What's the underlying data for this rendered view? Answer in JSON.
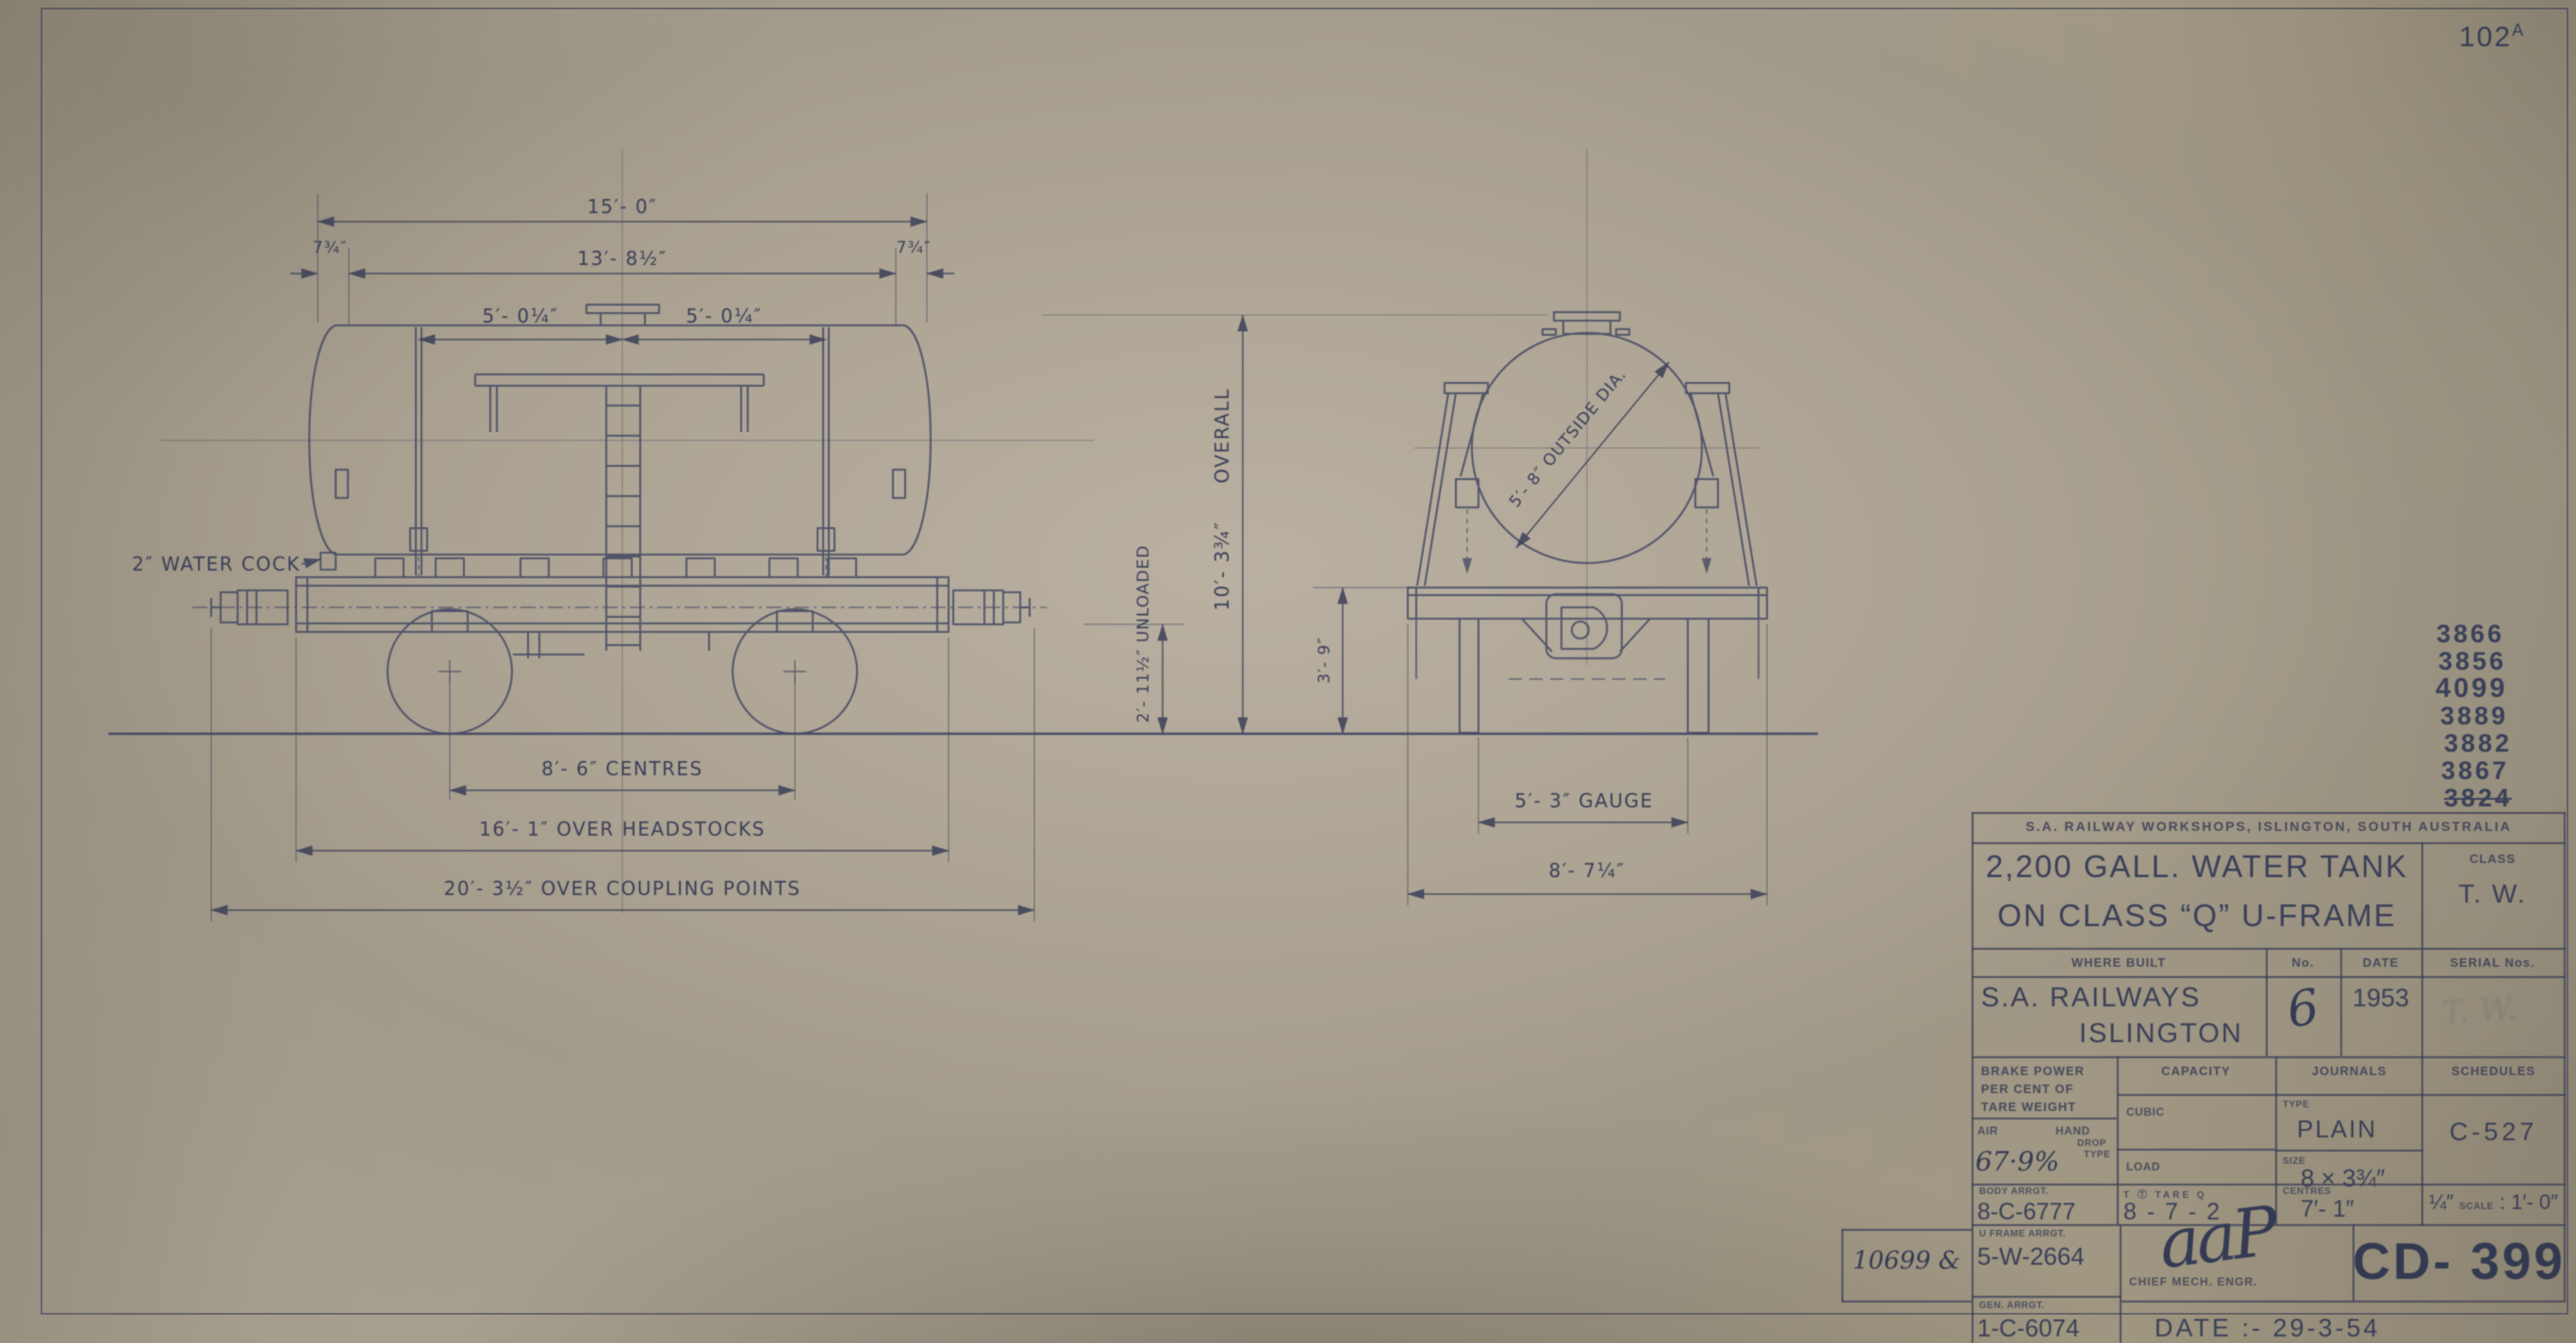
{
  "colors": {
    "paper": "#aaa292",
    "ink": "#3a3f58"
  },
  "sheet": {
    "number": "102",
    "number_suffix": "A",
    "date_note": "DATE :- 29-3-54"
  },
  "serials": {
    "list": [
      "3866",
      "3856",
      "4099",
      "3889",
      "3882",
      "3867"
    ],
    "struck": "3824"
  },
  "side_view": {
    "len_overall": "15′- 0″",
    "len_tank": "13′- 8½″",
    "end_offset": "7¾″",
    "half_left": "5′- 0¼″",
    "half_right": "5′- 0¼″",
    "water_cock": "2″ WATER COCK",
    "wheel_centres": "8′- 6″ CENTRES",
    "over_headstocks": "16′- 1″ OVER HEADSTOCKS",
    "over_coupling": "20′- 3½″ OVER COUPLING POINTS",
    "height_value": "10′- 3¾″",
    "height_word": "OVERALL",
    "unloaded": "2′- 11½″ UNLOADED",
    "beam_height": "3′- 9″"
  },
  "end_view": {
    "outside_dia": "5′- 8″ OUTSIDE DIA.",
    "gauge": "5′- 3″ GAUGE",
    "over_width": "8′- 7¼″"
  },
  "title_block": {
    "workshop": "S.A. RAILWAY WORKSHOPS, ISLINGTON, SOUTH AUSTRALIA",
    "title_line1": "2,200 GALL. WATER TANK",
    "title_line2": "ON CLASS “Q” U-FRAME",
    "class_label": "CLASS",
    "class_value": "T. W.",
    "where_built_label": "WHERE BUILT",
    "no_label": "No.",
    "date_label": "DATE",
    "serial_label": "SERIAL Nos.",
    "where_built_value1": "S.A. RAILWAYS",
    "where_built_value2": "ISLINGTON",
    "no_value": "6",
    "date_value": "1953",
    "serial_stamp": "T. W.",
    "brake_label1": "BRAKE POWER",
    "brake_label2": "PER CENT OF",
    "brake_label3": "TARE WEIGHT",
    "air_label": "AIR",
    "hand_label": "HAND",
    "hand_type1": "DROP",
    "hand_type2": "TYPE",
    "air_value": "67·9%",
    "capacity_label": "CAPACITY",
    "cubic_label": "CUBIC",
    "load_label": "LOAD",
    "journals_label": "JOURNALS",
    "type_label": "TYPE",
    "type_value": "PLAIN",
    "size_label": "SIZE",
    "size_value": "8 × 3¾″",
    "centres_label": "CENTRES",
    "centres_value": "7′- 1″",
    "schedules_label": "SCHEDULES",
    "schedules_value": "C-527",
    "body_label": "BODY ARRGT.",
    "body_value": "8-C-6777",
    "tare_label": "T Ⓣ TARE Q",
    "tare_value": "8 - 7 - 2",
    "scale_frac": "¼″",
    "scale_word": "SCALE",
    "scale_sep": ":",
    "scale_value": "1′- 0″",
    "uframe_label": "U FRAME ARRGT.",
    "uframe_value": "5-W-2664",
    "gen_label": "GEN. ARRGT.",
    "gen_value": "1-C-6074",
    "order_no": "10699 &",
    "signature": "aaP",
    "chief": "CHIEF MECH. ENGR.",
    "drawing_no": "CD- 399"
  }
}
